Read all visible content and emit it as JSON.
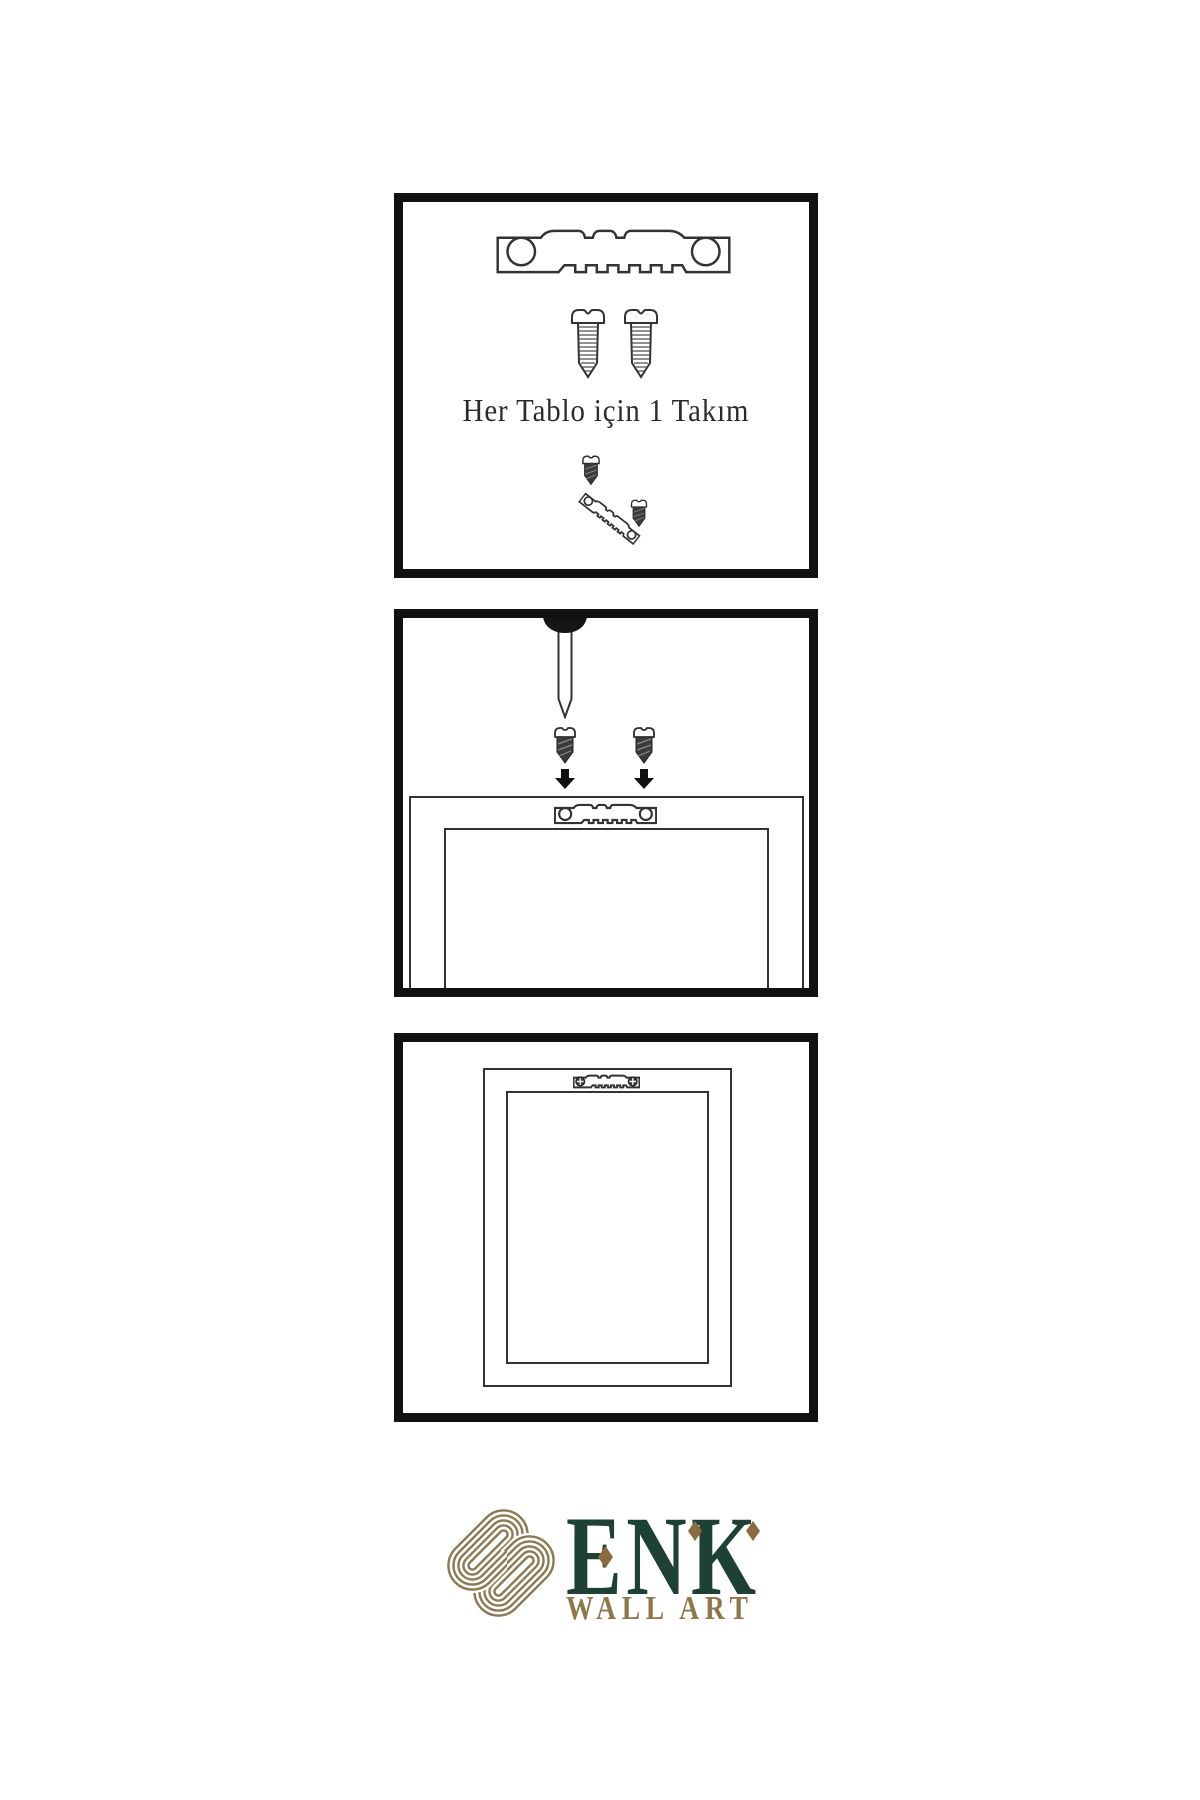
{
  "canvas": {
    "width": 1200,
    "height": 1800,
    "background": "#ffffff"
  },
  "steps": [
    {
      "id": "kit-contents",
      "caption": "Her Tablo için 1 Takım",
      "icons": [
        "sawtooth-hanger-icon",
        "screw-icon",
        "screw-icon",
        "screw-icon",
        "tilted-sawtooth-hanger-icon",
        "screw-icon"
      ]
    },
    {
      "id": "attach-hanger",
      "caption": "",
      "icons": [
        "nail-icon",
        "screw-icon",
        "screw-icon",
        "arrow-down-icon",
        "arrow-down-icon",
        "sawtooth-hanger-icon",
        "frame-back-outline"
      ]
    },
    {
      "id": "hang-frame",
      "caption": "",
      "icons": [
        "sawtooth-hanger-with-screws-icon",
        "frame-back-outline"
      ]
    }
  ],
  "logo": {
    "wordmark": "ENK",
    "tagline": "WALL ART",
    "icon": "knot-logo-icon"
  },
  "colors": {
    "panel_border": "#121212",
    "ink": "#333333",
    "metal_dark": "#3b3b3b",
    "logo_green": "#1d4134",
    "logo_gold": "#8b7950",
    "diamond_gold": "#8a6c3e"
  }
}
